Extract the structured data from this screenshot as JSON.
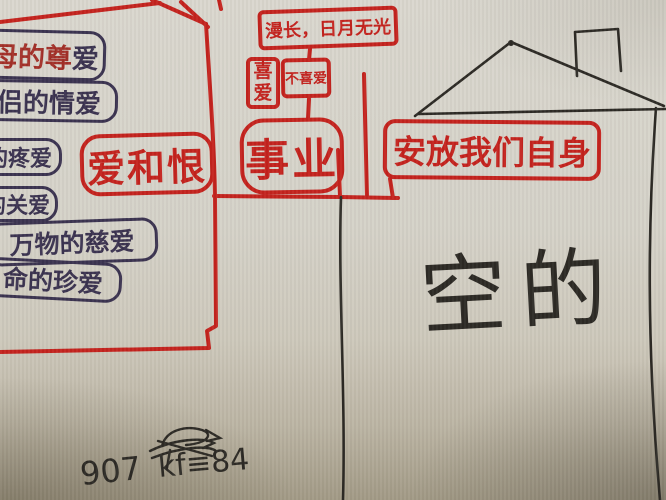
{
  "left_list": {
    "items": [
      {
        "text_red": "母的尊",
        "text_dark": "爱"
      },
      {
        "text": "侣的情爱"
      },
      {
        "text": "的疼爱"
      },
      {
        "text": "的关爱"
      },
      {
        "text": "万物的慈爱"
      },
      {
        "text": "命的珍爱"
      }
    ]
  },
  "mindmap": {
    "top_box_label": "漫长，日月无光",
    "like_label": "喜爱",
    "dislike_label": "不喜爱",
    "career_label": "事业",
    "love_hate_label": "爱和恨",
    "settle_label": "安放我们自身"
  },
  "house": {
    "label": "空的"
  },
  "notes": {
    "line1": "907",
    "line2": "kf≡84"
  },
  "colors": {
    "red_marker": "#c4231e",
    "ink_indigo": "#3b3350",
    "pen_black": "#2d2a25",
    "paper": "#d6d3c9"
  }
}
